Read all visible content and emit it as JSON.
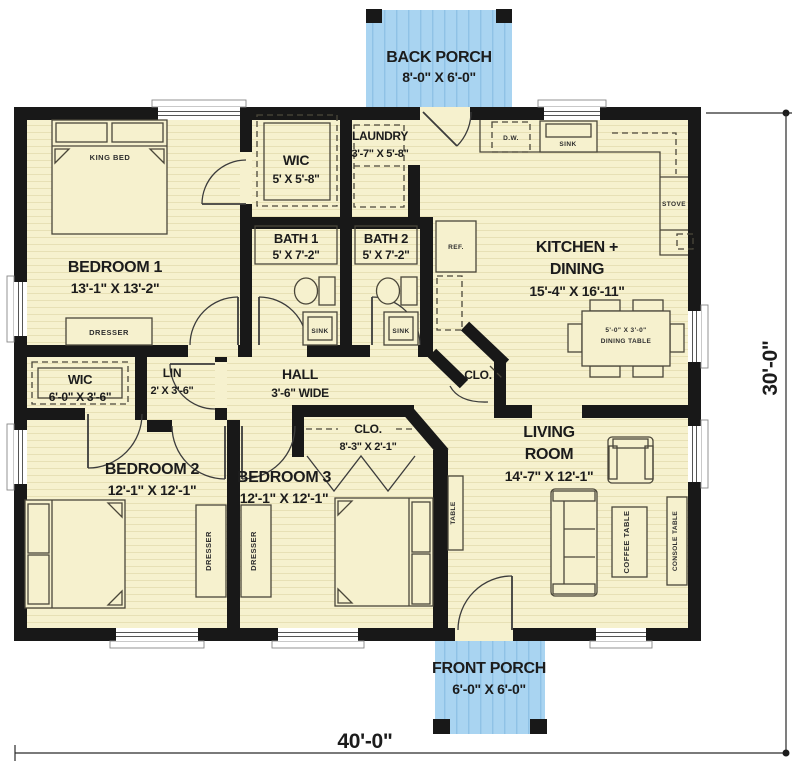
{
  "plan": {
    "overall_dimensions": {
      "width": "40'-0\"",
      "height": "30'-0\""
    },
    "porches": {
      "back": {
        "name": "BACK PORCH",
        "dims": "8'-0\" X 6'-0\""
      },
      "front": {
        "name": "FRONT PORCH",
        "dims": "6'-0\" X 6'-0\""
      }
    },
    "rooms": {
      "bedroom1": {
        "name": "BEDROOM 1",
        "dims": "13'-1\" X 13'-2\""
      },
      "wic1": {
        "name": "WIC",
        "dims": "5' X 5'-8\""
      },
      "laundry": {
        "name": "LAUNDRY",
        "dims": "3'-7\" X 5'-8\""
      },
      "kitchen": {
        "name_line1": "KITCHEN +",
        "name_line2": "DINING",
        "dims": "15'-4\" X 16'-11\""
      },
      "bath1": {
        "name": "BATH 1",
        "dims": "5' X 7'-2\""
      },
      "bath2": {
        "name": "BATH 2",
        "dims": "5' X 7'-2\""
      },
      "wic2": {
        "name": "WIC",
        "dims": "6'-0\" X 3'-6\""
      },
      "lin": {
        "name": "LIN",
        "dims": "2' X 3'-6\""
      },
      "hall": {
        "name": "HALL",
        "dims": "3'-6\" WIDE"
      },
      "closet_hall": {
        "name": "CLO."
      },
      "closet_bed3": {
        "name": "CLO.",
        "dims": "8'-3\" X 2'-1\""
      },
      "bedroom2": {
        "name": "BEDROOM 2",
        "dims": "12'-1\" X 12'-1\""
      },
      "bedroom3": {
        "name": "BEDROOM 3",
        "dims": "12'-1\" X 12'-1\""
      },
      "living": {
        "name_line1": "LIVING",
        "name_line2": "ROOM",
        "dims": "14'-7\" X 12'-1\""
      }
    },
    "furniture": {
      "king_bed": "KING BED",
      "dresser1": "DRESSER",
      "dresser2": "DRESSER",
      "dresser3": "DRESSER",
      "sink_bath1": "SINK",
      "sink_bath2": "SINK",
      "sink_kitchen": "SINK",
      "dishwasher": "D.W.",
      "stove": "STOVE",
      "fridge": "REF.",
      "dining_table_dims": "5'-0\" X 3'-0\"",
      "dining_table": "DINING TABLE",
      "coffee_table": "COFFEE TABLE",
      "console_table": "CONSOLE TABLE",
      "sofa_table": "TABLE"
    },
    "colors": {
      "floor": "#f6f1ce",
      "floor_line": "#e7e0b5",
      "porch": "#a9d4f1",
      "porch_line": "#8fc2e6",
      "wall": "#181818",
      "text": "#1c1c1c"
    }
  }
}
